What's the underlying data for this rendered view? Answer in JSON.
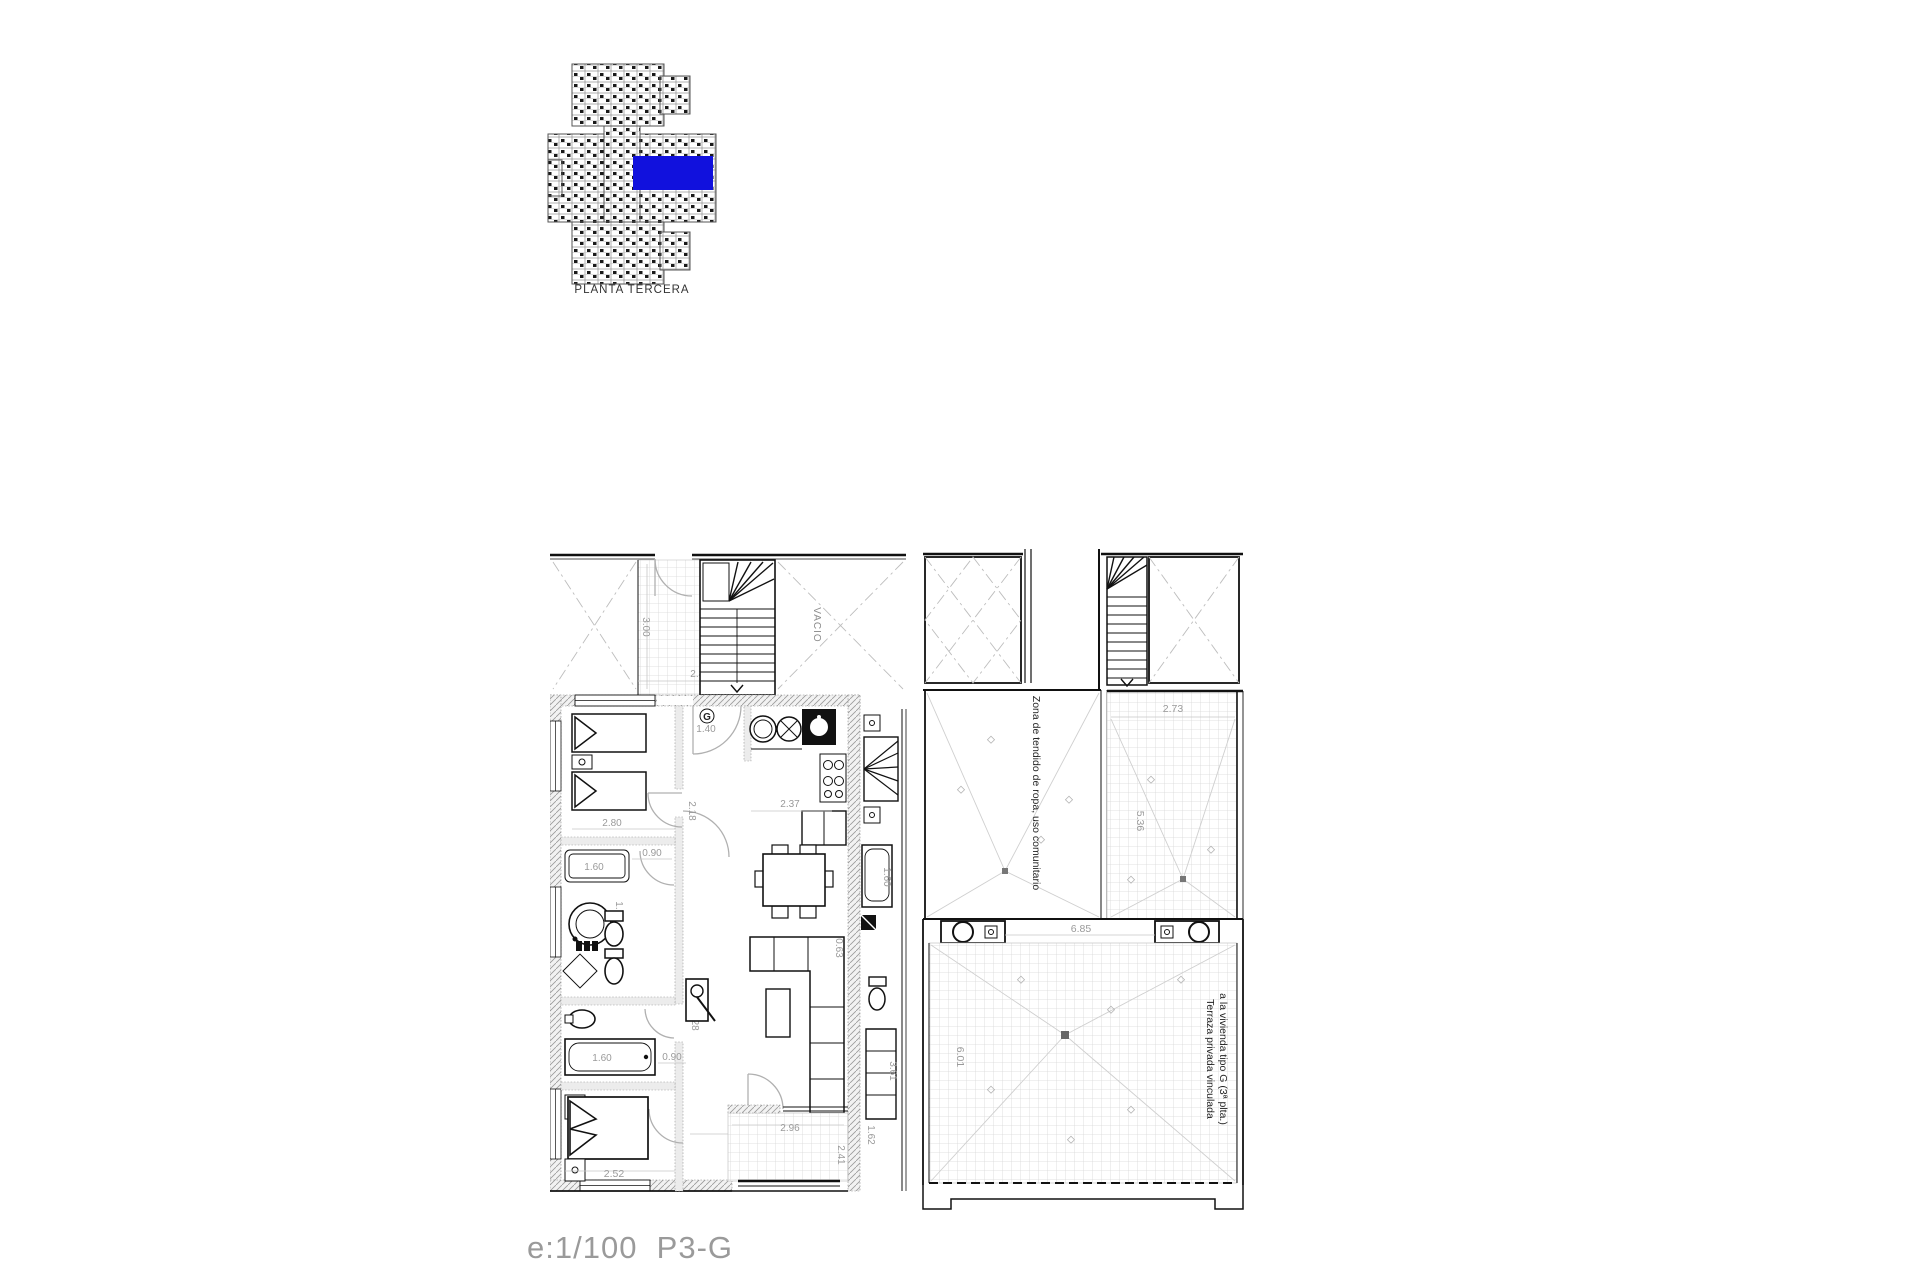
{
  "key_plan": {
    "caption": "PLANTA TERCERA",
    "highlight_color": "#1111dd"
  },
  "footer": {
    "scale_label": "e:1/100  P3-G"
  },
  "left_plan": {
    "void_label": "VACIO",
    "unit_label": "G",
    "dims": {
      "landing_h": "3.00",
      "landing_w": "2.80",
      "bed1_w": "2.80",
      "hall_top": "2.18",
      "entry_w": "1.40",
      "kitchen_w": "2.37",
      "shower_w": "1.60",
      "hall_mid": "0.90",
      "bath1_h": "1.79",
      "hall_low": "2.28",
      "tub_w": "1.60",
      "hall_bot": "0.90",
      "bed2_w": "2.52",
      "living_w": "3.87",
      "living_nook": "0.63",
      "terrace_w": "2.96",
      "terrace_h": "2.41",
      "neighbor_h": "3.61",
      "neighbor_tub": "1.60",
      "neighbor_terrace": "1.62"
    }
  },
  "right_plan": {
    "zona_label": "Zona de tendido de ropa, uso comunitario",
    "terraza_label_1": "Terraza privada vinculada",
    "terraza_label_2": "a la vivienda tipo G (3ª plta.)",
    "dims": {
      "upper_w": "2.73",
      "upper_h": "5.36",
      "main_w": "6.85",
      "main_h": "6.01"
    }
  }
}
